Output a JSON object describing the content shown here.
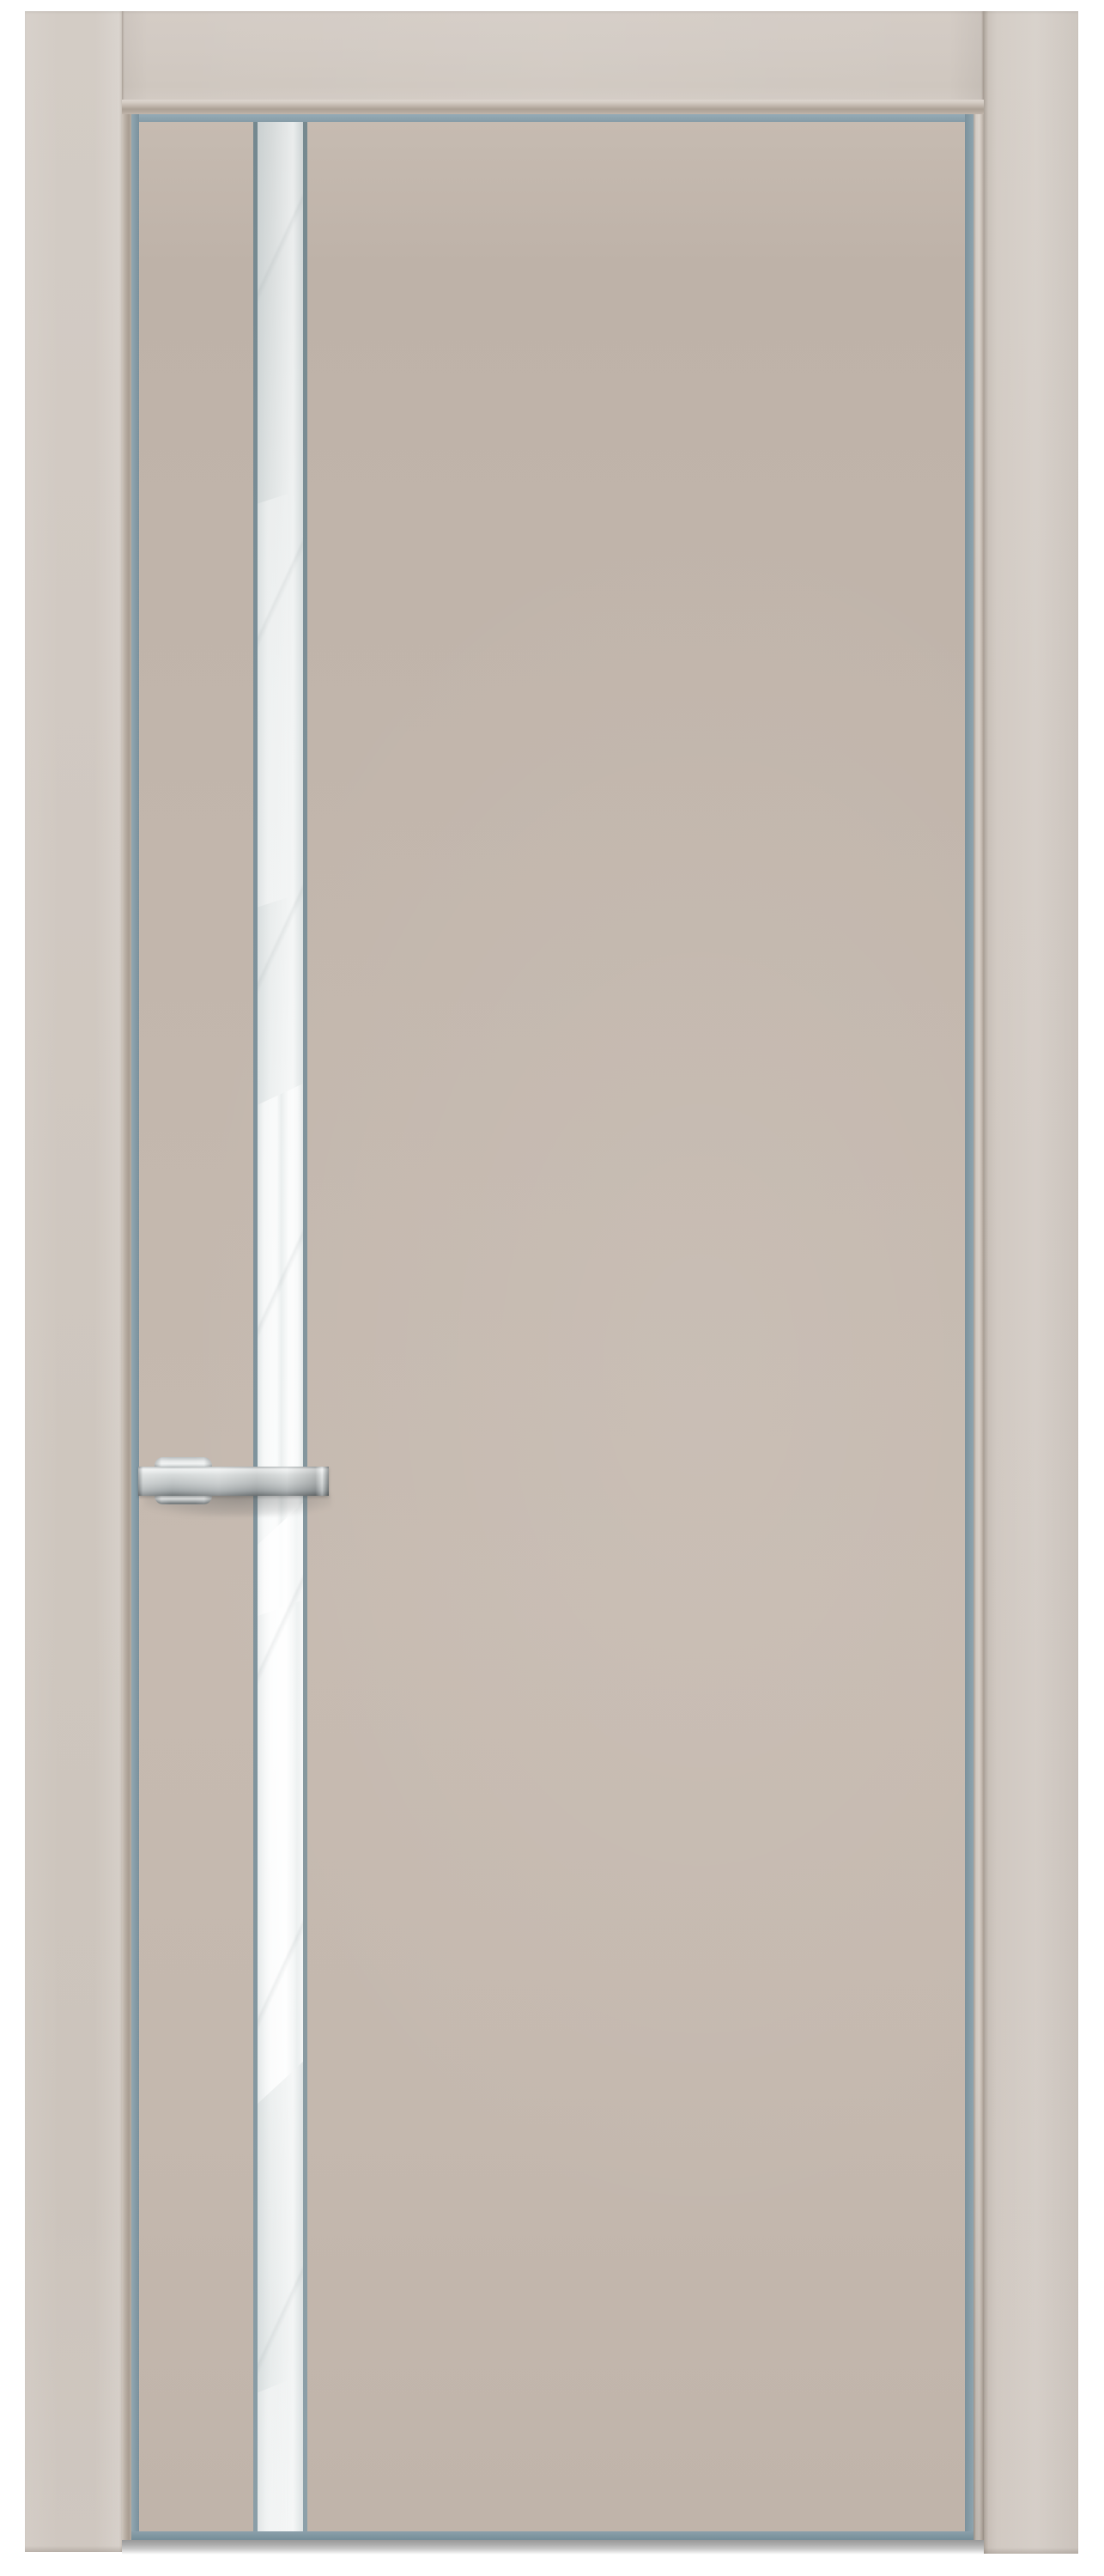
{
  "scene": {
    "subject": "interior door product photo",
    "door_style": "flush cashmere-colored door leaf with vertical white glass stripe, aluminum edge trim, stainless flag handle and matching door casing",
    "background_color": "#ffffff"
  },
  "palette": {
    "bg": "#ffffff",
    "casing_light": "#d4ccc5",
    "casing": "#d0c8c1",
    "casing_dark": "#c9c0b8",
    "molding_dark": "#aca196",
    "rebate_dark": "#a89d92",
    "panel_light": "#c9beb4",
    "panel": "#c3b7ad",
    "panel_dark": "#bcb0a6",
    "alu": "#8aa0ab",
    "alu_dark": "#7b919c",
    "bead": "#80949d",
    "glass_top": "#d5d9d9",
    "glass": "#eaeded",
    "glass_bright": "#f5f7f7",
    "steel_bright": "#f0f2f2",
    "steel": "#c6cacb",
    "steel_dark": "#6e7476",
    "floor_shadow": "#989898"
  }
}
